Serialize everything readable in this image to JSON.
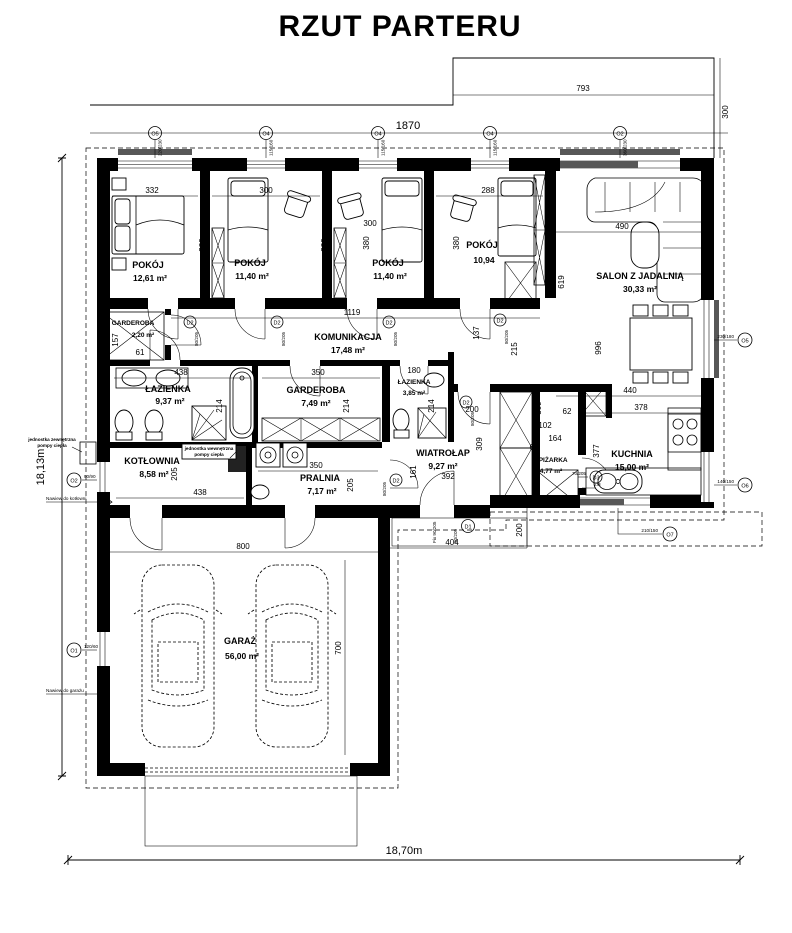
{
  "title": "RZUT PARTERU",
  "overall": {
    "width": "18,70m",
    "height": "18,13m",
    "top_width": "1870",
    "terrace_width": "793",
    "terrace_depth": "300"
  },
  "rooms": {
    "pokoj1": {
      "name": "POKÓJ",
      "area": "12,61 m²",
      "w": "332",
      "h": "380"
    },
    "pokoj2": {
      "name": "POKÓJ",
      "area": "11,40 m²",
      "w": "300",
      "h": "380"
    },
    "pokoj3": {
      "name": "POKÓJ",
      "area": "11,40 m²",
      "w": "300",
      "h": "380"
    },
    "pokoj4": {
      "name": "POKÓJ",
      "area": "10,94",
      "w": "288",
      "h": "380"
    },
    "salon": {
      "name": "SALON Z JADALNIĄ",
      "area": "30,33 m²",
      "d1": "490",
      "d2": "619",
      "d3": "996"
    },
    "garderoba1": {
      "name": "GARDEROBA",
      "area": "2,20 m²",
      "w": "61",
      "h": "157"
    },
    "komunikacja": {
      "name": "KOMUNIKACJA",
      "area": "17,48 m²",
      "w": "1119",
      "h": "137",
      "d1": "215"
    },
    "lazienka1": {
      "name": "ŁAZIENKA",
      "area": "9,37 m²",
      "w": "438",
      "h": "214"
    },
    "garderoba2": {
      "name": "GARDEROBA",
      "area": "7,49 m²",
      "w": "350",
      "h": "214"
    },
    "lazienka2": {
      "name": "ŁAZIENKA",
      "area": "3,85 m²",
      "w": "180",
      "h": "214"
    },
    "wiatrolap": {
      "name": "WIATROŁAP",
      "area": "9,27 m²",
      "w": "392",
      "h": "161",
      "d1": "200",
      "d2": "309"
    },
    "spizarka": {
      "name": "SPIŻARKA",
      "area": "4,77 m²",
      "d1": "309",
      "d2": "102",
      "d3": "62",
      "d4": "164",
      "d5": "64"
    },
    "kuchnia": {
      "name": "KUCHNIA",
      "area": "15,00 m²",
      "d1": "440",
      "d2": "378",
      "d3": "377"
    },
    "kotlownia": {
      "name": "KOTŁOWNIA",
      "area": "8,58 m²",
      "w": "438",
      "h": "205"
    },
    "pralnia": {
      "name": "PRALNIA",
      "area": "7,17 m²",
      "w": "350",
      "h": "205"
    },
    "garaz": {
      "name": "GARAŻ",
      "area": "56,00 m²",
      "w": "800",
      "h": "700"
    }
  },
  "entry": {
    "w": "404",
    "d": "200"
  },
  "annotations": {
    "heat_pump_outdoor_1": "jednostka zewnętrzna",
    "heat_pump_outdoor_2": "pompy ciepła",
    "heat_pump_indoor_1": "jednostka wewnętrzna",
    "heat_pump_indoor_2": "pompy ciepła",
    "vent_boiler": "Nawiew do kotłowni",
    "vent_garage": "Nawiew do garażu",
    "dishwasher": "ZM",
    "fix_glazing": "Fix 90/205"
  },
  "markers": {
    "o1": {
      "id": "O1",
      "size": "120/60"
    },
    "o2": {
      "id": "O2",
      "size": "90/90"
    },
    "o2b": {
      "id": "O2",
      "size": "360/230"
    },
    "o4": {
      "id": "O4",
      "size": "115/160"
    },
    "o5": {
      "id": "O5",
      "size": "220/230"
    },
    "o5b": {
      "id": "O5",
      "size": "230/180"
    },
    "o6": {
      "id": "O6",
      "size": "140/150"
    },
    "o7": {
      "id": "O7",
      "size": "210/150"
    },
    "d1": {
      "id": "D1",
      "size": "90/205"
    },
    "d2": {
      "id": "D2",
      "size": "80/205"
    },
    "d3": {
      "id": "D3",
      "size": "70/205"
    }
  }
}
